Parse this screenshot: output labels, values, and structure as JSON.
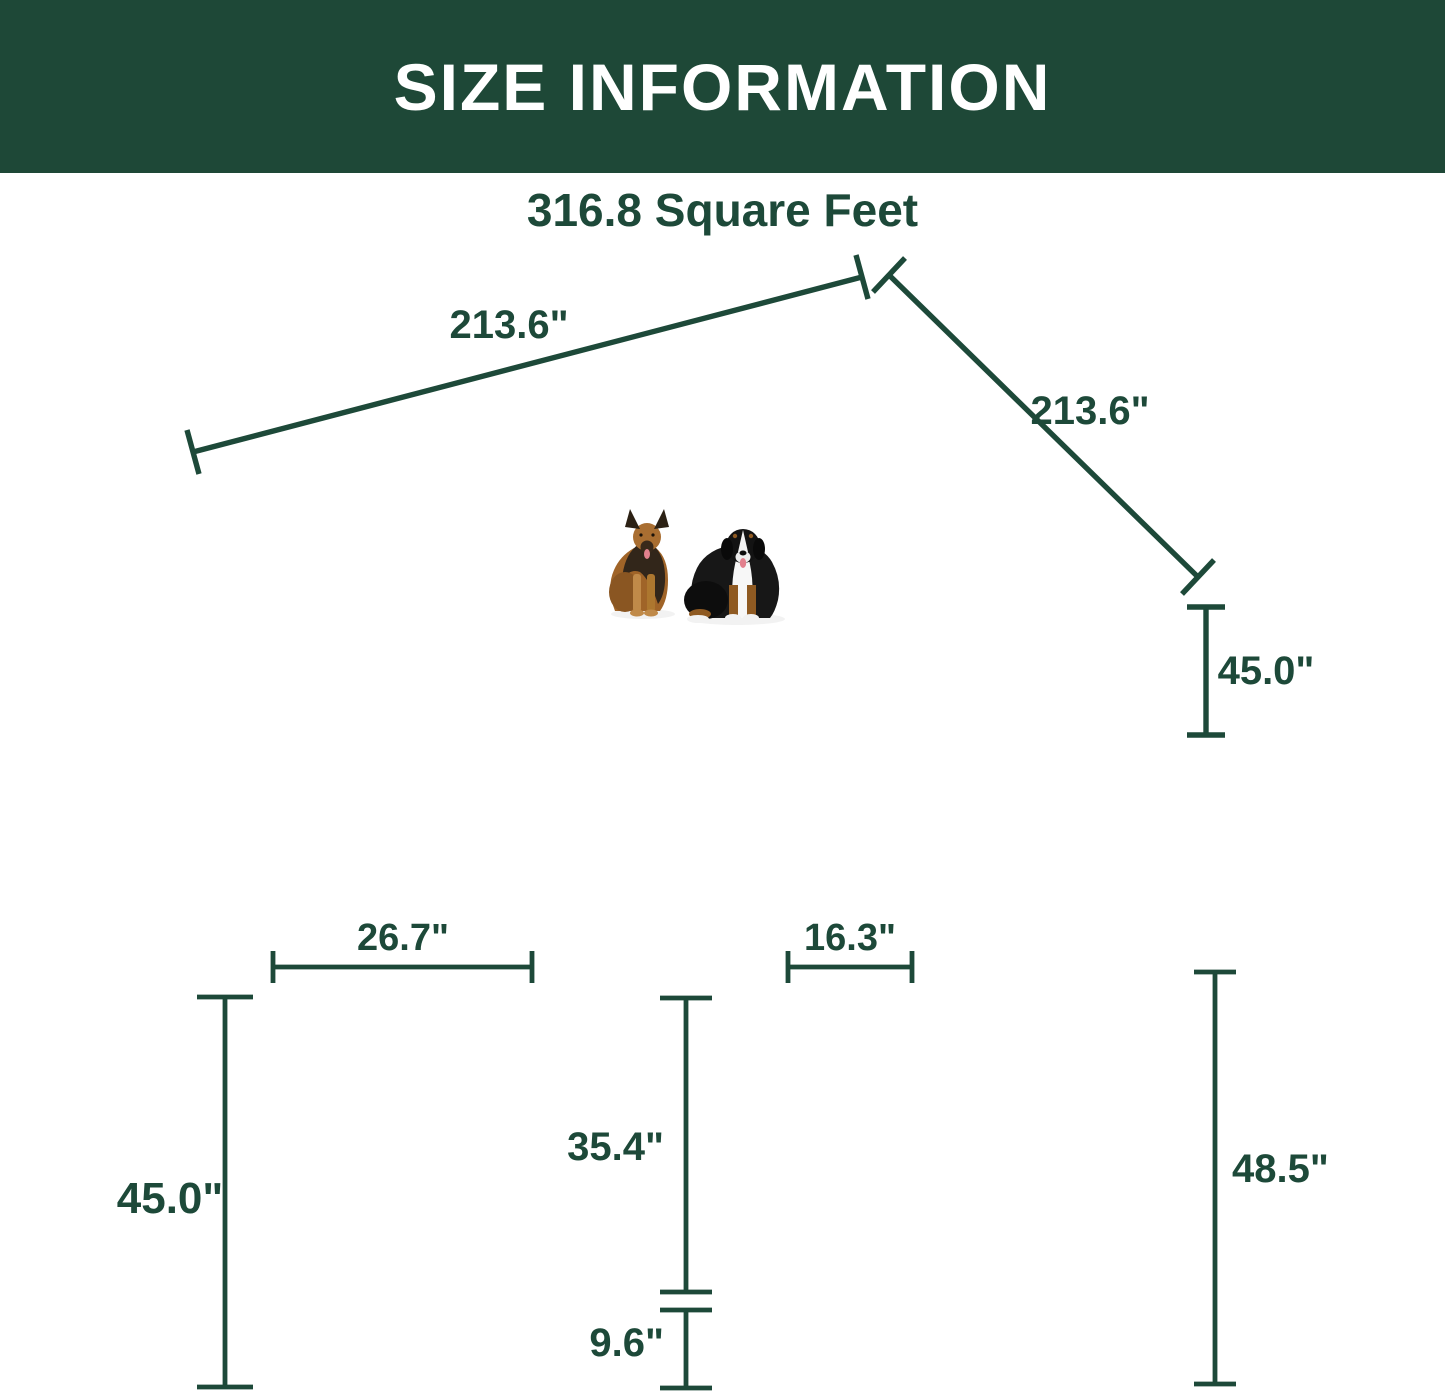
{
  "header": {
    "title": "SIZE INFORMATION"
  },
  "colors": {
    "header_bg": "#1e4837",
    "accent": "#1d4939",
    "fence": "#1a1a1a"
  },
  "overview": {
    "area_label": "316.8 Square Feet",
    "dim_top_length": "213.6\"",
    "dim_right_length": "213.6\"",
    "dim_height": "45.0\""
  },
  "panel_detail": {
    "dim_width": "26.7\"",
    "dim_height": "45.0\""
  },
  "gate_detail": {
    "dim_door_width": "16.3\"",
    "dim_door_height": "35.4\"",
    "dim_bottom_height": "9.6\""
  },
  "stake_detail": {
    "dim_height": "48.5\""
  }
}
